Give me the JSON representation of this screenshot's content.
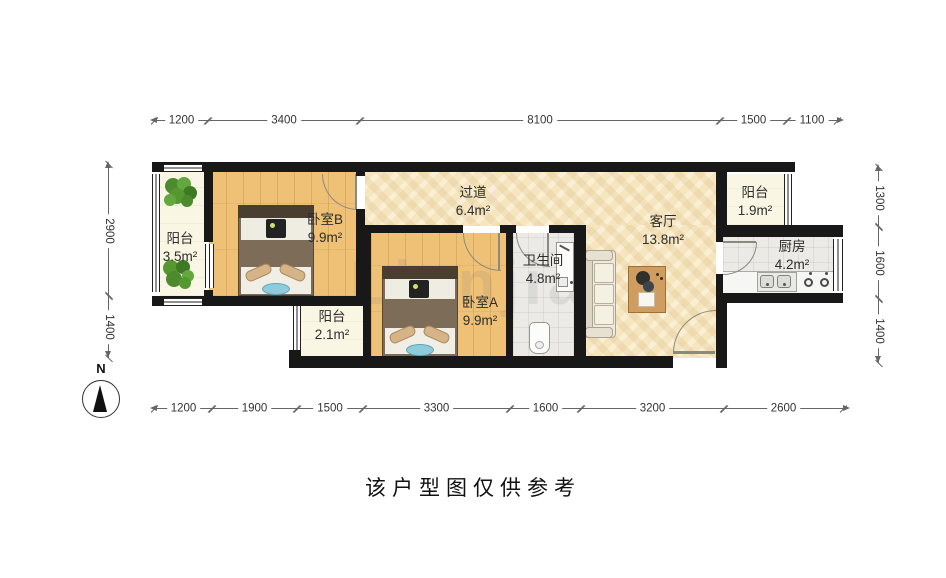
{
  "caption": "该户型图仅供参考",
  "north_label": "N",
  "watermark": "Lianjia",
  "rooms": [
    {
      "name": "阳台",
      "area": "3.5m²"
    },
    {
      "name": "卧室B",
      "area": "9.9m²"
    },
    {
      "name": "过道",
      "area": "6.4m²"
    },
    {
      "name": "阳台",
      "area": "2.1m²"
    },
    {
      "name": "卧室A",
      "area": "9.9m²"
    },
    {
      "name": "卫生间",
      "area": "4.8m²"
    },
    {
      "name": "客厅",
      "area": "13.8m²"
    },
    {
      "name": "阳台",
      "area": "1.9m²"
    },
    {
      "name": "厨房",
      "area": "4.2m²"
    }
  ],
  "dims": {
    "top": [
      "1200",
      "3400",
      "8100",
      "1500",
      "1100"
    ],
    "bottom": [
      "1200",
      "1900",
      "1500",
      "3300",
      "1600",
      "3200",
      "2600"
    ],
    "left": [
      "2900",
      "1400"
    ],
    "right": [
      "1300",
      "1600",
      "1400"
    ]
  },
  "colors": {
    "wall": "#181818",
    "wood_floor": "#efc177",
    "hall_floor": "#f5e6c0",
    "balcony_floor": "#faf6e4",
    "tile_floor": "#ebeae6"
  }
}
